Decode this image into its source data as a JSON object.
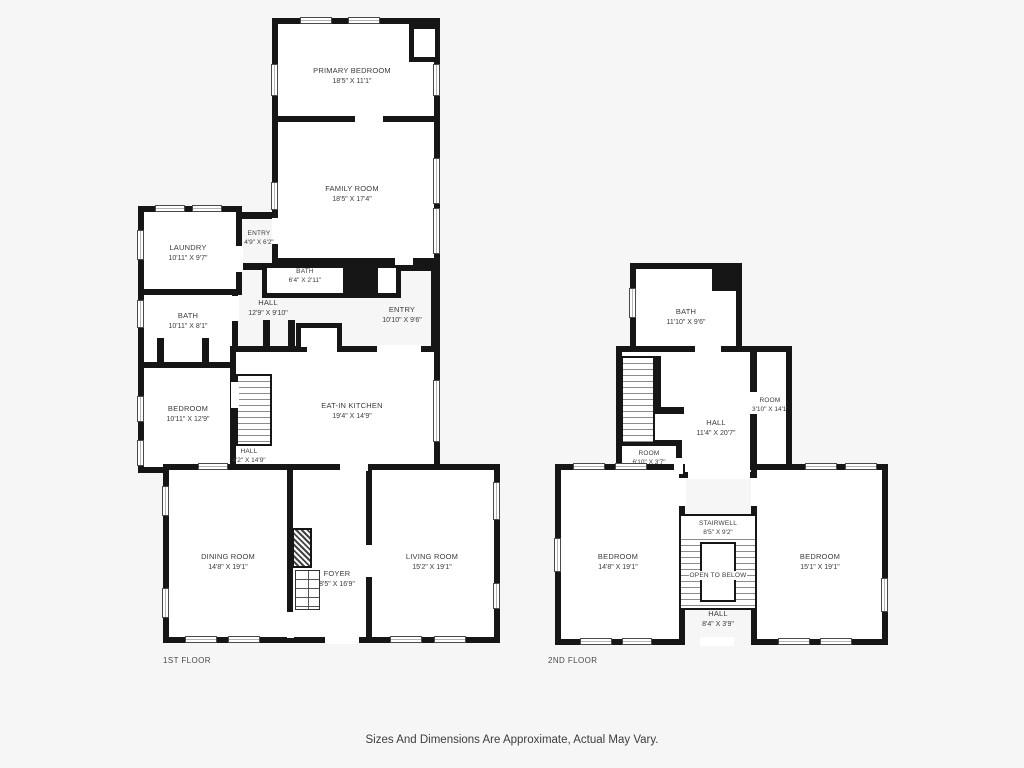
{
  "colors": {
    "background": "#f6f6f6",
    "wall": "#161616",
    "text": "#3b3b3b"
  },
  "floor1": {
    "label": "1ST FLOOR",
    "rooms": {
      "primary_bedroom": {
        "name": "PRIMARY BEDROOM",
        "dims": "18'5\" X 11'1\""
      },
      "family_room": {
        "name": "FAMILY ROOM",
        "dims": "18'5\" X 17'4\""
      },
      "entry_upper": {
        "name": "ENTRY",
        "dims": "4'9\" X 6'2\""
      },
      "laundry": {
        "name": "LAUNDRY",
        "dims": "10'11\" X 9'7\""
      },
      "bath_small": {
        "name": "BATH",
        "dims": "6'4\" X 2'11\""
      },
      "hall_main": {
        "name": "HALL",
        "dims": "12'9\" X 9'10\""
      },
      "entry_side": {
        "name": "ENTRY",
        "dims": "10'10\" X 9'6\""
      },
      "bath": {
        "name": "BATH",
        "dims": "10'11\" X 8'1\""
      },
      "bedroom": {
        "name": "BEDROOM",
        "dims": "10'11\" X 12'9\""
      },
      "kitchen": {
        "name": "EAT-IN KITCHEN",
        "dims": "19'4\" X 14'9\""
      },
      "hall_lower": {
        "name": "HALL",
        "dims": "4'2\" X 14'9\""
      },
      "dining_room": {
        "name": "DINING ROOM",
        "dims": "14'8\" X 19'1\""
      },
      "foyer": {
        "name": "FOYER",
        "dims": "8'5\" X 16'9\""
      },
      "living_room": {
        "name": "LIVING ROOM",
        "dims": "15'2\" X 19'1\""
      }
    }
  },
  "floor2": {
    "label": "2ND FLOOR",
    "rooms": {
      "bath": {
        "name": "BATH",
        "dims": "11'10\" X 9'6\""
      },
      "hall_upper": {
        "name": "HALL",
        "dims": "11'4\" X 20'7\""
      },
      "room_small": {
        "name": "ROOM",
        "dims": "6'10\" X 3'7\""
      },
      "room_narrow": {
        "name": "ROOM",
        "dims": "3'10\" X 14'1\""
      },
      "bedroom_left": {
        "name": "BEDROOM",
        "dims": "14'8\" X 19'1\""
      },
      "stairwell": {
        "name": "STAIRWELL",
        "dims": "8'5\" X 9'2\""
      },
      "open_to_below": {
        "name": "OPEN TO BELOW"
      },
      "hall_lower": {
        "name": "HALL",
        "dims": "8'4\" X 3'9\""
      },
      "bedroom_right": {
        "name": "BEDROOM",
        "dims": "15'1\" X 19'1\""
      }
    }
  },
  "footer": {
    "disclaimer": "Sizes And Dimensions Are Approximate, Actual May Vary."
  }
}
